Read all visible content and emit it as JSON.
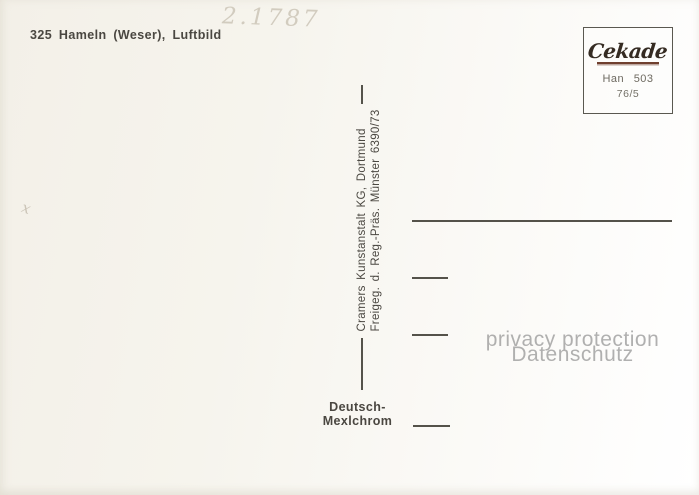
{
  "postcard": {
    "caption": "325 Hameln (Weser), Luftbild",
    "handwritten_number": "2.1787",
    "handwritten_mark": "x",
    "publisher_line1": "Cramers Kunstanstalt KG, Dortmund",
    "publisher_line2": "Freigeg. d. Reg.-Präs. Münster 6390/73",
    "process_line1": "Deutsch-",
    "process_line2": "Mexlchrom",
    "stamp_box": {
      "brand": "Cekade",
      "code": "Han 503",
      "series": "76/5"
    },
    "watermark": {
      "line1": "privacy protection",
      "line2": "Datenschutz"
    },
    "colors": {
      "ink": "#4a4741",
      "divider_line": "#55534b",
      "address_line": "#54524a",
      "pencil": "#d2ccbf",
      "logo_ink": "#352b22",
      "logo_underline": "#6f3f2e",
      "stamp_text": "#6e6a61",
      "watermark_gray": "#8d8d8d",
      "paper_cream": "#f3f0e8"
    }
  }
}
